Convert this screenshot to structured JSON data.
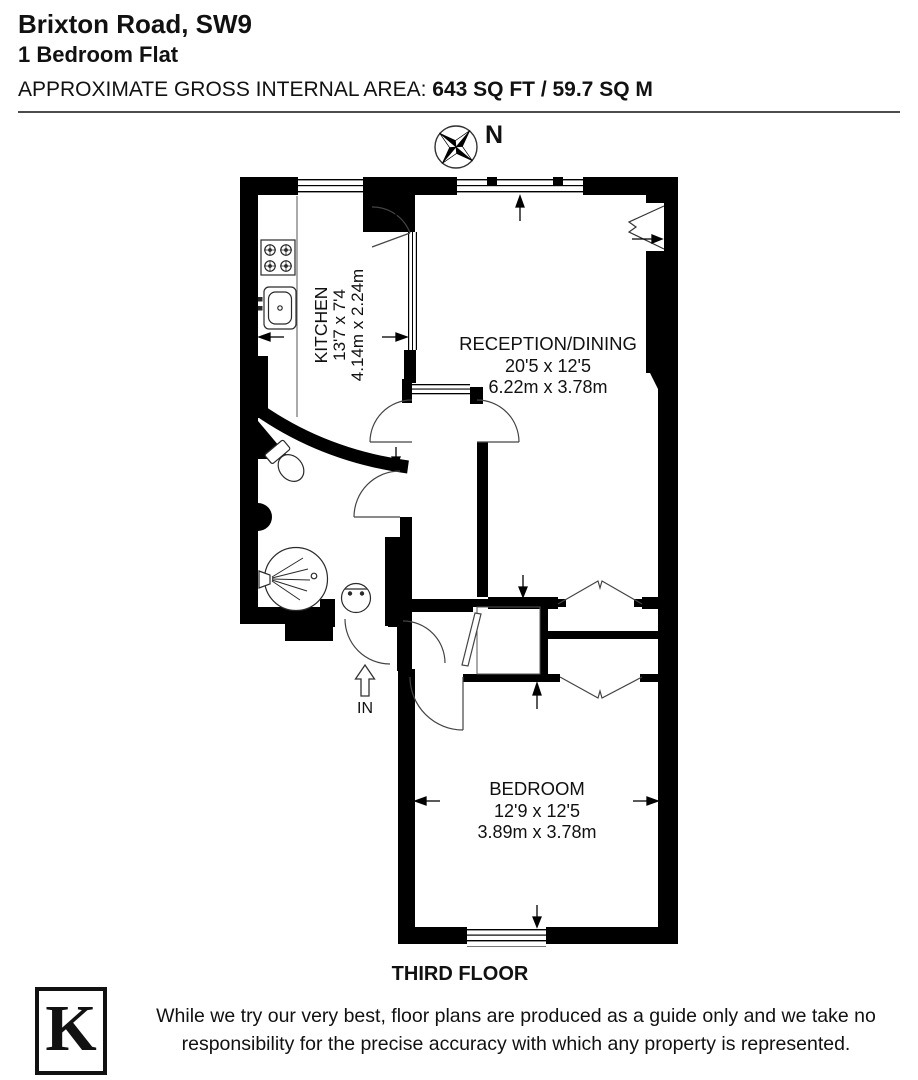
{
  "header": {
    "title": "Brixton Road, SW9",
    "subtitle": "1 Bedroom Flat",
    "area_label": "APPROXIMATE GROSS INTERNAL AREA:",
    "area_value": "643 SQ FT / 59.7 SQ M"
  },
  "compass": {
    "north_label": "N"
  },
  "rooms": {
    "kitchen": {
      "name": "KITCHEN",
      "dims_imperial": "13'7 x 7'4",
      "dims_metric": "4.14m x 2.24m"
    },
    "reception": {
      "name": "RECEPTION/DINING",
      "dims_imperial": "20'5 x 12'5",
      "dims_metric": "6.22m x 3.78m"
    },
    "bedroom": {
      "name": "BEDROOM",
      "dims_imperial": "12'9 x 12'5",
      "dims_metric": "3.89m x 3.78m"
    }
  },
  "entrance_label": "IN",
  "floor_label": "THIRD FLOOR",
  "footer": {
    "logo_letter": "K",
    "disclaimer": "While we try our very best, floor plans are produced as a guide only and we take no responsibility for the precise accuracy with which any property is represented."
  },
  "colors": {
    "wall": "#000000",
    "background": "#ffffff",
    "thin_line": "#333333"
  }
}
